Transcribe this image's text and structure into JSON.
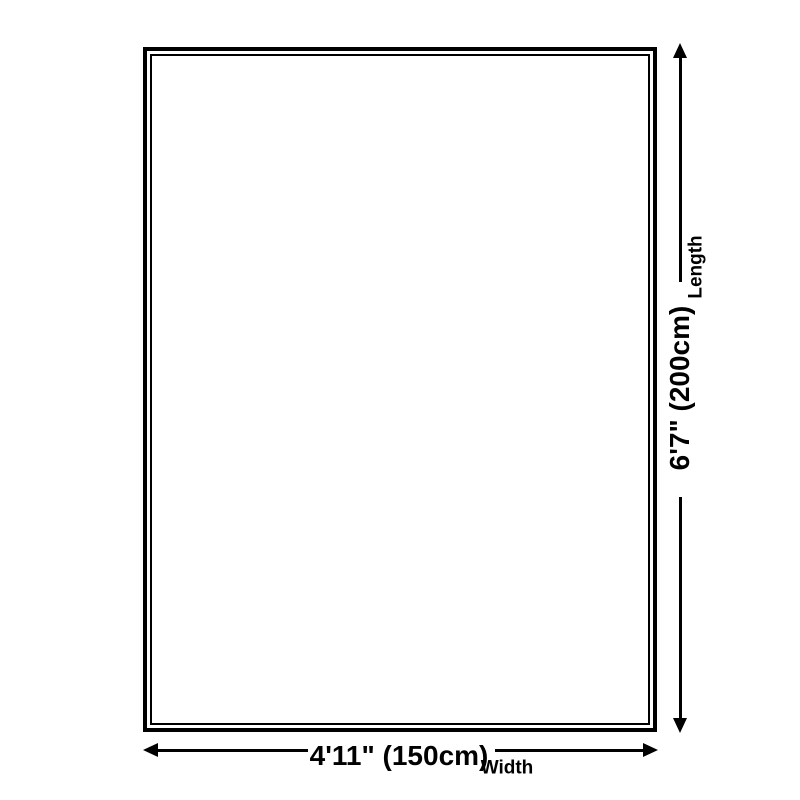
{
  "dimensions": {
    "length": {
      "value": "6'7\" (200cm)",
      "label": "Length"
    },
    "width": {
      "value": "4'11\" (150cm)",
      "label": "Width"
    }
  },
  "colors": {
    "line": "#000000",
    "text": "#000000",
    "background": "#ffffff"
  }
}
